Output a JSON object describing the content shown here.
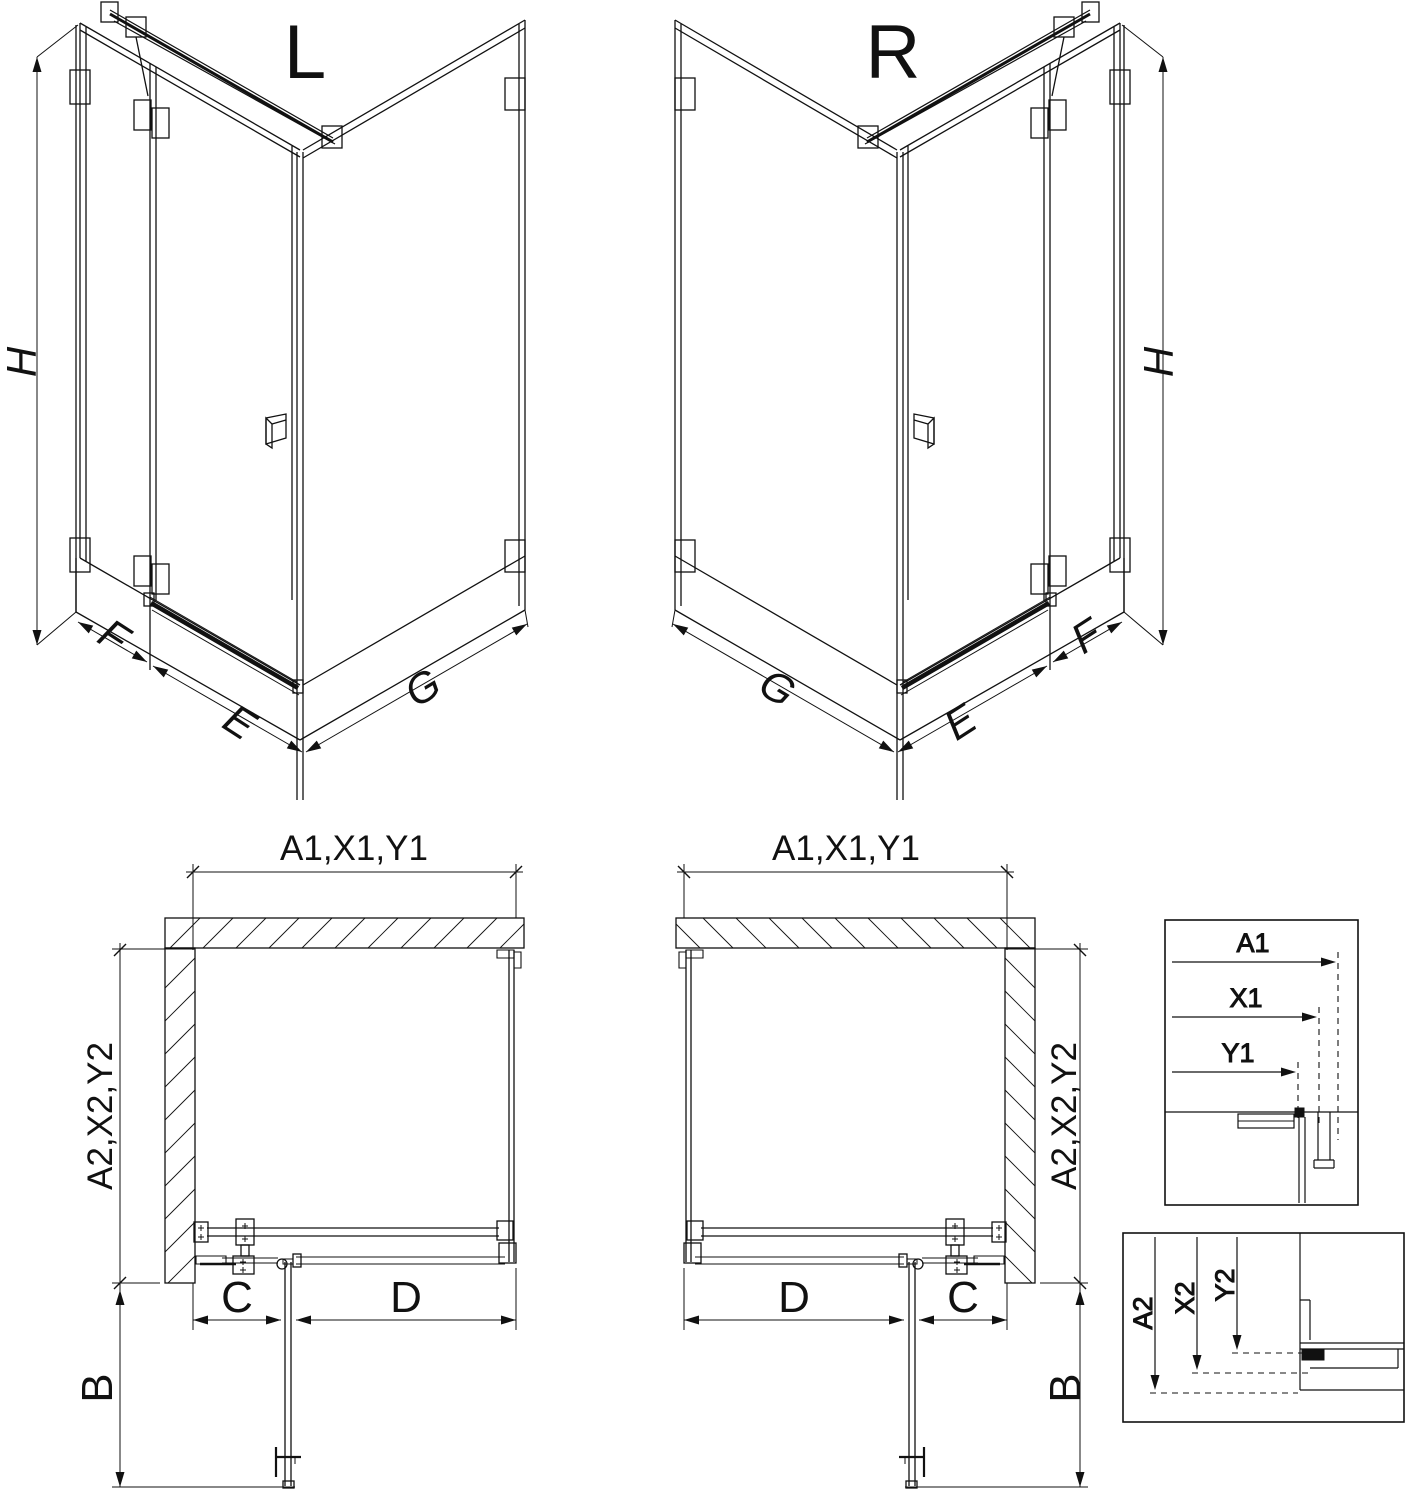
{
  "drawing": {
    "iso_left": {
      "title": "L",
      "height": "H",
      "side_fixed": "F",
      "door": "E",
      "return_panel": "G"
    },
    "iso_right": {
      "title": "R",
      "height": "H",
      "side_fixed": "F",
      "door": "E",
      "return_panel": "G"
    },
    "plan_left": {
      "width": "A1,X1,Y1",
      "depth": "A2,X2,Y2",
      "door_swing": "B",
      "fixed_segment": "C",
      "door_width": "D"
    },
    "plan_right": {
      "width": "A1,X1,Y1",
      "depth": "A2,X2,Y2",
      "door_swing": "B",
      "fixed_segment": "C",
      "door_width": "D"
    },
    "detail_horizontal": {
      "a": "A1",
      "x": "X1",
      "y": "Y1"
    },
    "detail_vertical": {
      "a": "A2",
      "x": "X2",
      "y": "Y2"
    }
  },
  "colors": {
    "line": "#111111",
    "background": "#ffffff"
  }
}
